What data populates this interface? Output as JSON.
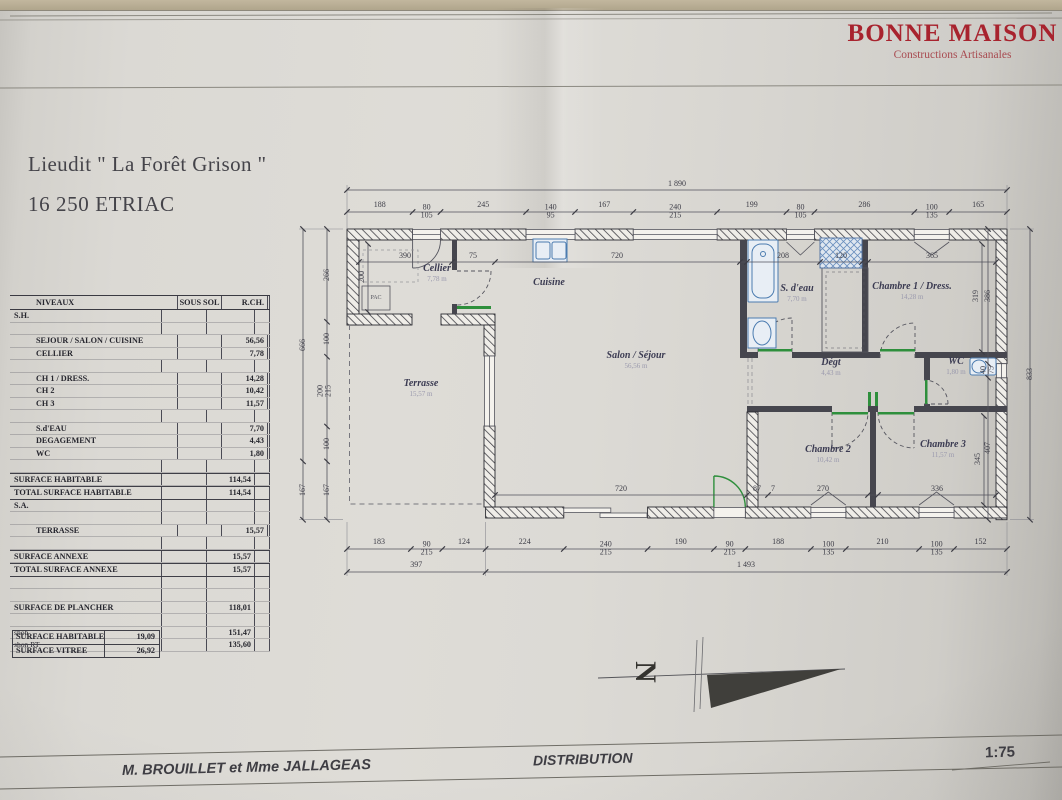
{
  "logo": {
    "title": "BONNE MAISON",
    "subtitle": "Constructions Artisanales"
  },
  "header": {
    "location": "Lieudit \" La Forêt Grison \"",
    "city": "16 250 ETRIAC"
  },
  "areas_table": {
    "headers": {
      "levels": "NIVEAUX",
      "sous_sol": "SOUS SOL",
      "rdc": "R.CH.",
      "etage": "ETAGE"
    },
    "rows": [
      {
        "label": "S.H.",
        "rdc": ""
      },
      {
        "label": "",
        "rdc": ""
      },
      {
        "label": "SEJOUR / SALON / CUISINE",
        "rdc": "56,56"
      },
      {
        "label": "CELLIER",
        "rdc": "7,78"
      },
      {
        "label": "",
        "rdc": ""
      },
      {
        "label": "CH 1 / DRESS.",
        "rdc": "14,28"
      },
      {
        "label": "CH 2",
        "rdc": "10,42"
      },
      {
        "label": "CH 3",
        "rdc": "11,57"
      },
      {
        "label": "",
        "rdc": ""
      },
      {
        "label": "S.d'EAU",
        "rdc": "7,70"
      },
      {
        "label": "DEGAGEMENT",
        "rdc": "4,43"
      },
      {
        "label": "WC",
        "rdc": "1,80"
      },
      {
        "label": "",
        "rdc": ""
      },
      {
        "label": "SURFACE HABITABLE",
        "rdc": "114,54"
      },
      {
        "label": "TOTAL SURFACE HABITABLE",
        "rdc": "114,54"
      },
      {
        "label": "S.A.",
        "rdc": ""
      },
      {
        "label": "",
        "rdc": ""
      },
      {
        "label": "TERRASSE",
        "rdc": "15,57"
      },
      {
        "label": "",
        "rdc": ""
      },
      {
        "label": "SURFACE ANNEXE",
        "rdc": "15,57"
      },
      {
        "label": "TOTAL SURFACE ANNEXE",
        "rdc": "15,57"
      },
      {
        "label": "",
        "rdc": ""
      },
      {
        "label": "",
        "rdc": ""
      },
      {
        "label": "SURFACE DE PLANCHER",
        "rdc": "118,01"
      },
      {
        "label": "",
        "rdc": ""
      },
      {
        "label": "shob",
        "rdc": "151,47"
      },
      {
        "label": "shon RT",
        "rdc": "135,60"
      }
    ]
  },
  "summary_table": {
    "rows": [
      {
        "label": "SURFACE HABITABLE",
        "value": "19,09"
      },
      {
        "label": "SURFACE VITREE",
        "value": "26,92"
      }
    ]
  },
  "plan": {
    "pac_label": "PAC",
    "rooms": [
      {
        "name": "Cellier",
        "area": "7,78 m"
      },
      {
        "name": "Cuisine",
        "area": ""
      },
      {
        "name": "Salon / Séjour",
        "area": "56,56 m"
      },
      {
        "name": "Terrasse",
        "area": "15,57 m"
      },
      {
        "name": "S. d'eau",
        "area": "7,70 m"
      },
      {
        "name": "Chambre 1 / Dress.",
        "area": "14,28 m"
      },
      {
        "name": "Dégt",
        "area": "4,43 m"
      },
      {
        "name": "WC",
        "area": "1,80 m"
      },
      {
        "name": "Chambre 2",
        "area": "10,42 m"
      },
      {
        "name": "Chambre 3",
        "area": "11,57 m"
      }
    ],
    "dims": {
      "top_total": "1 890",
      "top": [
        "188",
        "80\n105",
        "245",
        "140\n95",
        "167",
        "240\n215",
        "199",
        "80\n105",
        "286",
        "100\n135",
        "165"
      ],
      "bottom": [
        "183",
        "90\n215",
        "124",
        "224",
        "240\n215",
        "190",
        "90\n215",
        "188",
        "100\n135",
        "210",
        "100\n135",
        "152"
      ],
      "bottom_sub": [
        "397",
        "1 493"
      ],
      "left_outer": [
        "666",
        "167"
      ],
      "left_inner": [
        "266",
        "100",
        "200\n215",
        "100",
        "167"
      ],
      "right_inner": [
        "386",
        "40\n75",
        "407"
      ],
      "right_outer": [
        "833"
      ],
      "inner_top": [
        "390",
        "75",
        "720",
        "208",
        "120",
        "365"
      ],
      "inner_bottom": [
        "720",
        "87",
        "7",
        "270",
        "336"
      ],
      "inner_vertical": [
        "200",
        "319",
        "345"
      ]
    }
  },
  "north": {
    "label": "N"
  },
  "footer": {
    "client": "M. BROUILLET et Mme JALLAGEAS",
    "title": "DISTRIBUTION",
    "scale": "1:75"
  }
}
